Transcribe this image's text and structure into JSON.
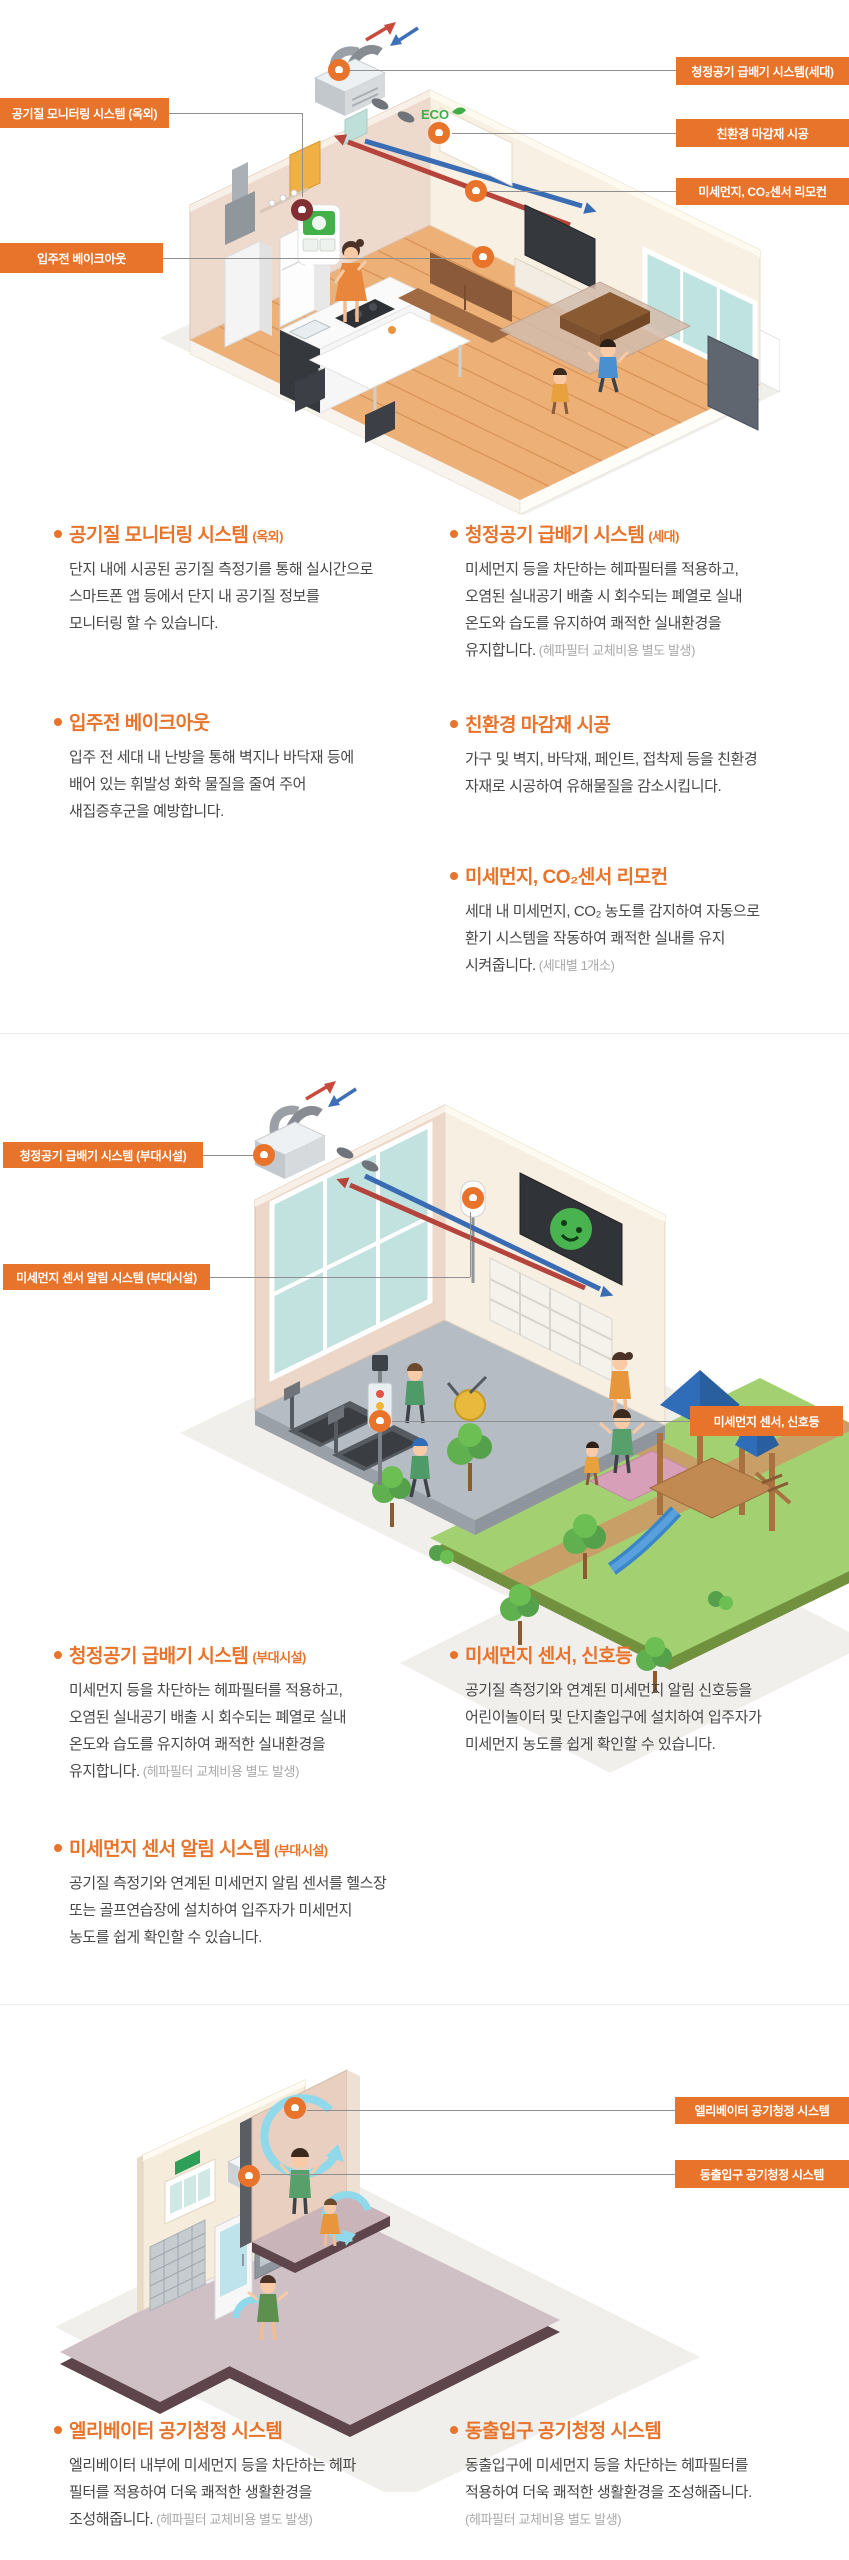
{
  "palette": {
    "orange": "#E8732A",
    "maroon": "#822F33",
    "connector": "#8F8F8F",
    "body_text": "#474747",
    "note_text": "#A9A9A9"
  },
  "illustration_labels": {
    "eco_badge": "ECO"
  },
  "sections": {
    "unit": {
      "callouts": {
        "monitoring": "공기질 모니터링 시스템 (옥외)",
        "bakeout": "입주전 베이크아웃",
        "supply": "청정공기 급배기 시스템(세대)",
        "finish": "친환경 마감재 시공",
        "remote": "미세먼지, CO₂센서 리모컨"
      },
      "features": {
        "monitoring": {
          "title": "공기질 모니터링 시스템",
          "suffix": "(옥외)",
          "lines": [
            "단지 내에 시공된 공기질 측정기를 통해 실시간으로",
            "스마트폰 앱 등에서 단지 내 공기질 정보를",
            "모니터링 할 수 있습니다."
          ]
        },
        "bakeout": {
          "title": "입주전 베이크아웃",
          "suffix": "",
          "lines": [
            "입주 전 세대 내 난방을 통해 벽지나 바닥재 등에",
            "배어 있는 휘발성 화학 물질을 줄여 주어",
            "새집증후군을 예방합니다."
          ]
        },
        "supply": {
          "title": "청정공기 급배기 시스템",
          "suffix": "(세대)",
          "lines": [
            "미세먼지 등을 차단하는 헤파필터를 적용하고,",
            "오염된 실내공기 배출 시 회수되는 폐열로 실내",
            "온도와 습도를 유지하여 쾌적한 실내환경을"
          ],
          "last": "유지합니다.",
          "note": "(헤파필터 교체비용 별도 발생)"
        },
        "finish": {
          "title": "친환경 마감재 시공",
          "suffix": "",
          "lines": [
            "가구 및 벽지, 바닥재, 페인트, 접착제 등을 친환경",
            "자재로 시공하여 유해물질을 감소시킵니다."
          ]
        },
        "remote": {
          "title": "미세먼지, CO₂센서 리모컨",
          "suffix": "",
          "lines": [
            "세대 내 미세먼지, CO₂ 농도를 감지하여 자동으로",
            "환기 시스템을 작동하여 쾌적한 실내를 유지"
          ],
          "last": "시켜줍니다.",
          "note": "(세대별 1개소)"
        }
      }
    },
    "amenity": {
      "callouts": {
        "supply": "청정공기 급배기 시스템 (부대시설)",
        "alarm": "미세먼지 센서 알림 시스템 (부대시설)",
        "signal": "미세먼지 센서, 신호등"
      },
      "features": {
        "supply": {
          "title": "청정공기 급배기 시스템",
          "suffix": "(부대시설)",
          "lines": [
            "미세먼지 등을 차단하는 헤파필터를 적용하고,",
            "오염된 실내공기 배출 시 회수되는 폐열로 실내",
            "온도와 습도를 유지하여 쾌적한 실내환경을"
          ],
          "last": "유지합니다.",
          "note": "(헤파필터 교체비용 별도 발생)"
        },
        "alarm": {
          "title": "미세먼지 센서 알림 시스템",
          "suffix": "(부대시설)",
          "lines": [
            "공기질 측정기와 연계된 미세먼지 알림 센서를 헬스장",
            "또는 골프연습장에 설치하여 입주자가 미세먼지",
            "농도를 쉽게 확인할 수 있습니다."
          ]
        },
        "signal": {
          "title": "미세먼지 센서, 신호등",
          "suffix": "",
          "lines": [
            "공기질 측정기와 연계된 미세먼지 알림 신호등을",
            "어린이놀이터 및 단지출입구에 설치하여 입주자가",
            "미세먼지 농도를 쉽게 확인할 수 있습니다."
          ]
        }
      }
    },
    "lobby": {
      "callouts": {
        "elevator": "엘리베이터 공기청정 시스템",
        "entrance": "동출입구 공기청정 시스템"
      },
      "features": {
        "elevator": {
          "title": "엘리베이터 공기청정 시스템",
          "suffix": "",
          "lines": [
            "엘리베이터 내부에 미세먼지 등을 차단하는 헤파",
            "필터를 적용하여 더욱 쾌적한 생활환경을"
          ],
          "last": "조성해줍니다.",
          "note": "(헤파필터 교체비용 별도 발생)"
        },
        "entrance": {
          "title": "동출입구 공기청정 시스템",
          "suffix": "",
          "lines": [
            "동출입구에 미세먼지 등을 차단하는 헤파필터를",
            "적용하여 더욱 쾌적한 생활환경을 조성해줍니다."
          ],
          "note_line": "(헤파필터 교체비용 별도 발생)"
        }
      }
    }
  }
}
